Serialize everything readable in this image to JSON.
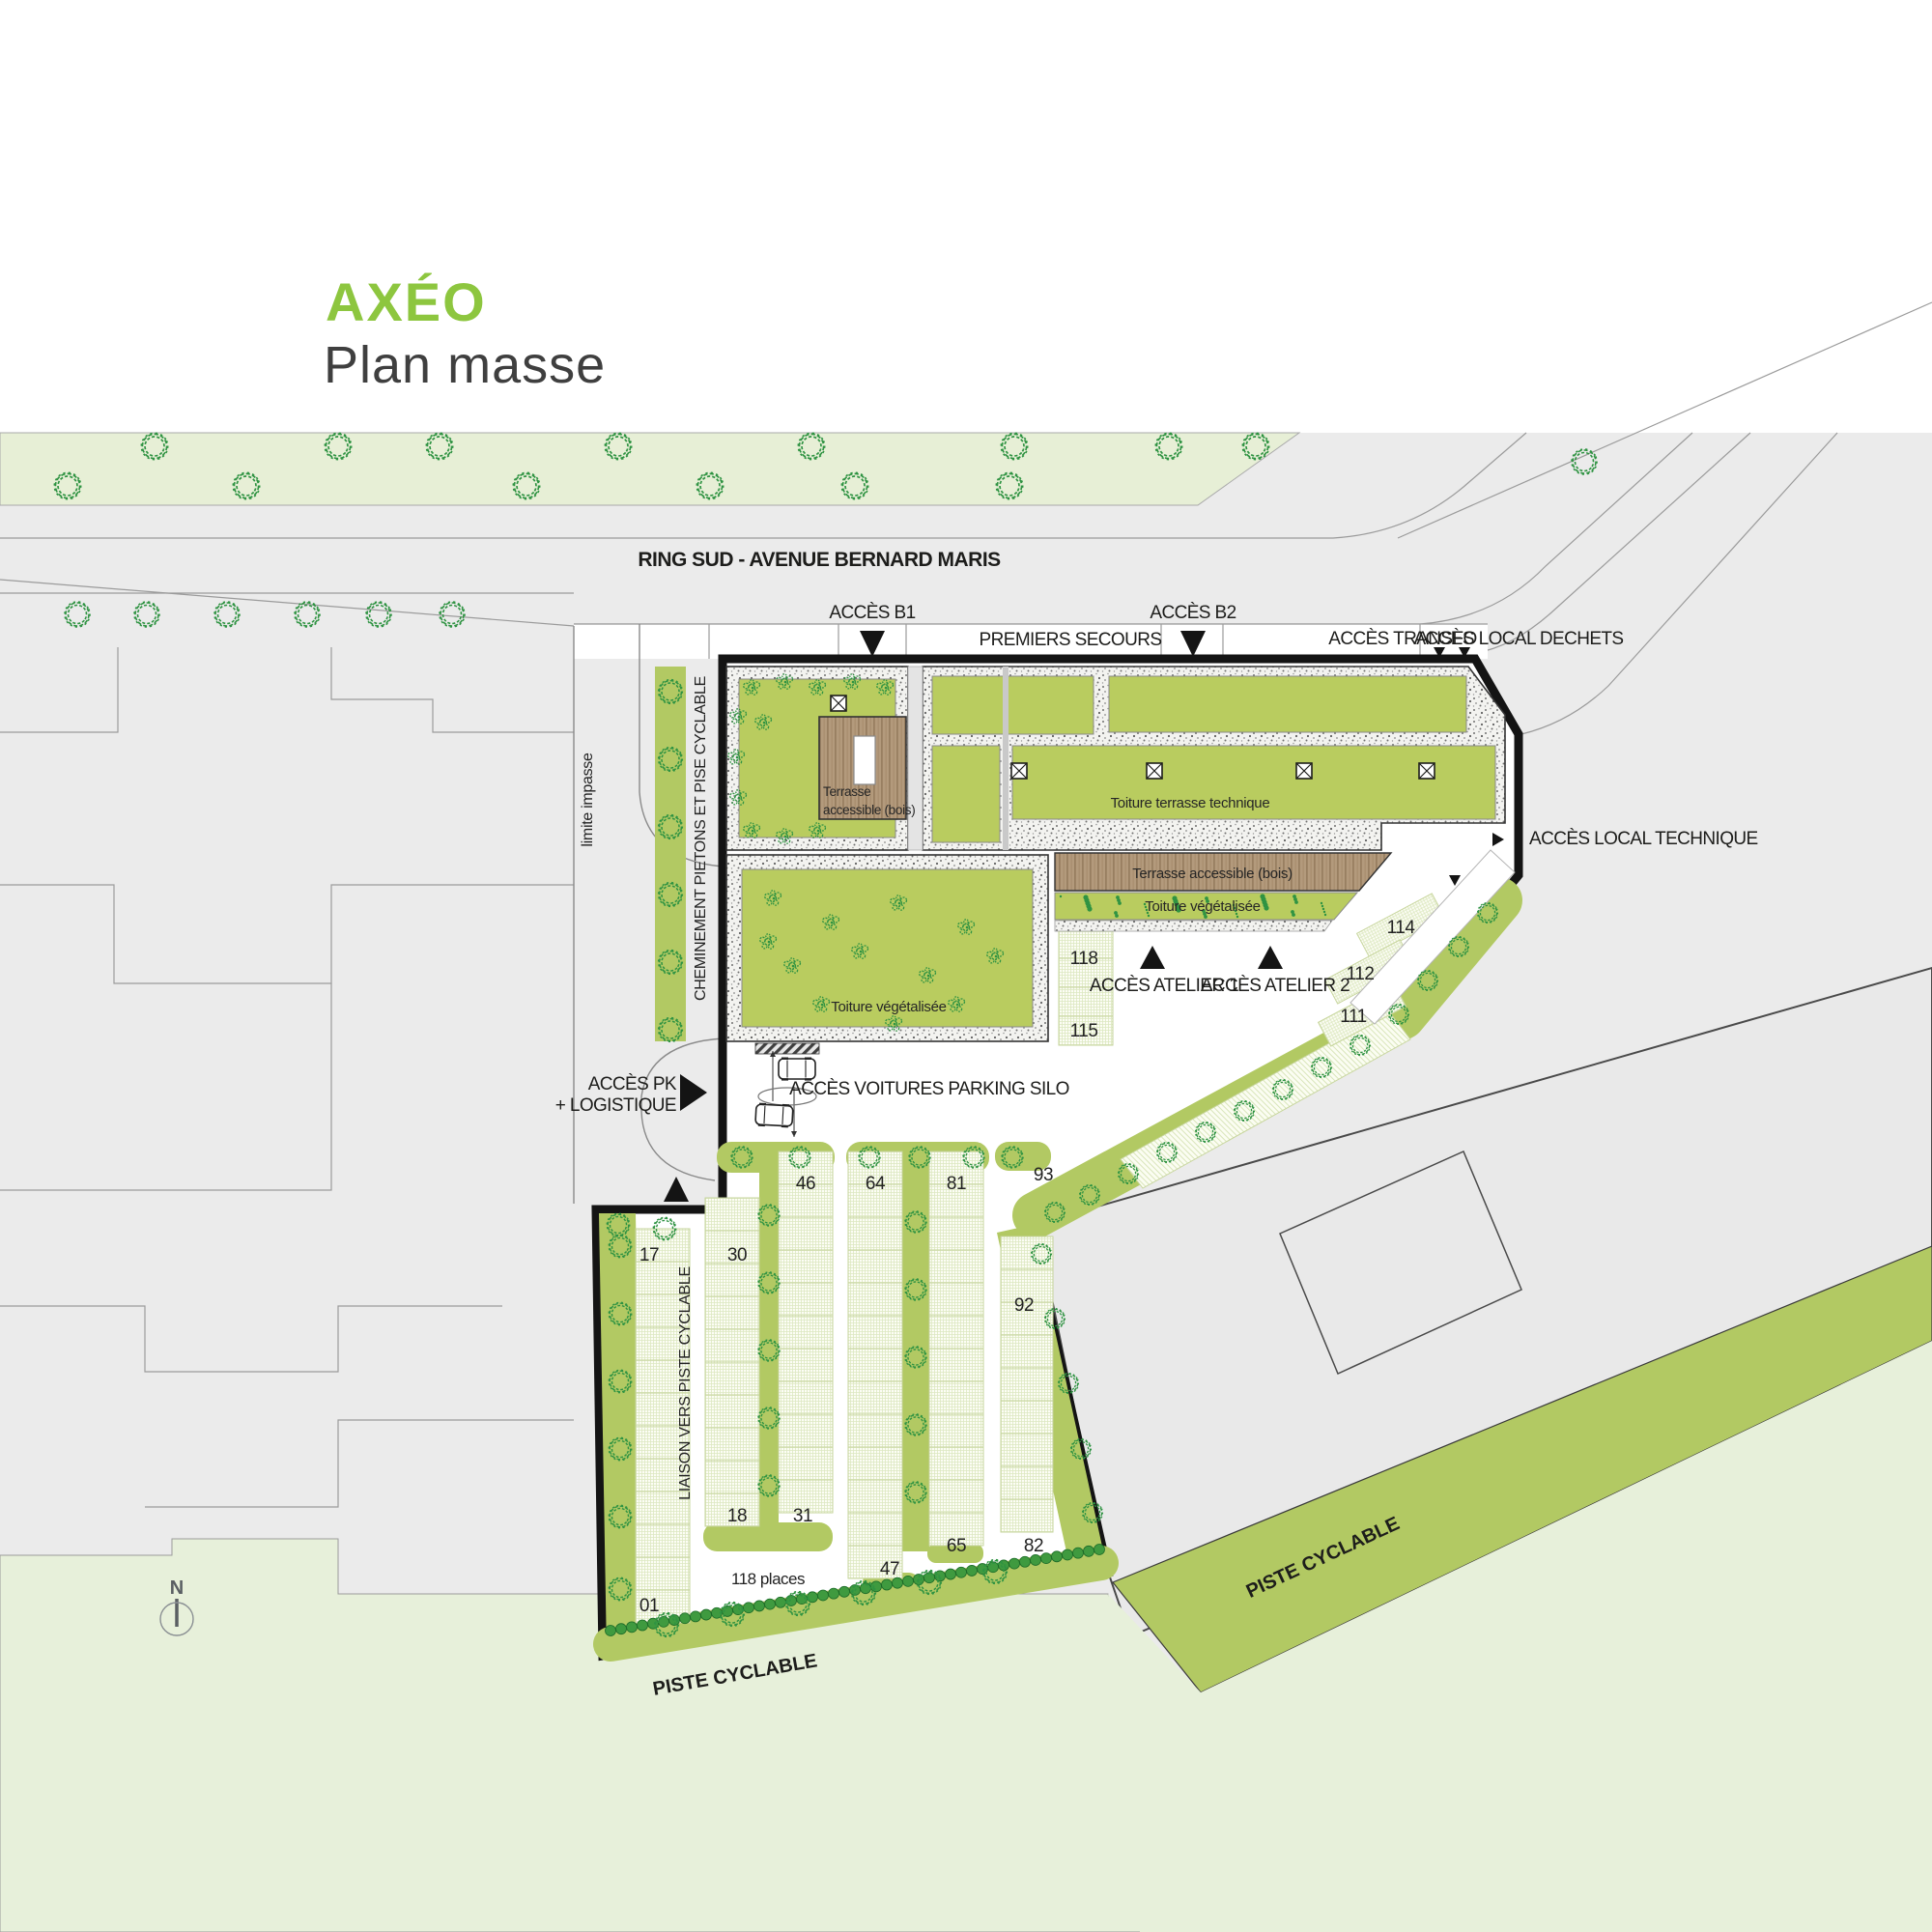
{
  "header": {
    "title": "AXÉO",
    "subtitle": "Plan masse"
  },
  "roads": {
    "main": "RING SUD - AVENUE BERNARD MARIS",
    "piste_left": "PISTE CYCLABLE",
    "piste_right": "PISTE CYCLABLE"
  },
  "access": {
    "b1": "ACCÈS B1",
    "b2": "ACCÈS B2",
    "premiers_secours": "PREMIERS SECOURS",
    "transfo": "ACCÈS TRANSFO",
    "local_dechets": "ACCÈS LOCAL DECHETS",
    "local_technique": "ACCÈS LOCAL TECHNIQUE",
    "atelier1": "ACCÈS ATELIER 1",
    "atelier2": "ACCÈS ATELIER 2",
    "pk_line1": "ACCÈS PK",
    "pk_line2": "+ LOGISTIQUE",
    "voitures_silo": "ACCÈS VOITURES PARKING SILO"
  },
  "roofs": {
    "terrasse_bois_line1": "Terrasse",
    "terrasse_bois_line2": "accessible (bois)",
    "terrasse_bois_2": "Terrasse accessible (bois)",
    "toiture_technique": "Toiture terrasse technique",
    "toiture_vegetalisee_1": "Toiture végétalisée",
    "toiture_vegetalisee_2": "Toiture végétalisée"
  },
  "paths": {
    "cheminement": "CHEMINEMENT PIETONS ET PISE CYCLABLE",
    "limite_impasse": "limite impasse",
    "liaison": "LIAISON VERS PISTE CYCLABLE"
  },
  "parking": {
    "total": "118 places",
    "bays": {
      "b118": "118",
      "b115": "115",
      "b114": "114",
      "b112": "112",
      "b111": "111",
      "b93": "93",
      "b92": "92",
      "b46": "46",
      "b64": "64",
      "b81": "81",
      "b17": "17",
      "b30": "30",
      "b18": "18",
      "b31": "31",
      "b47": "47",
      "b65": "65",
      "b82": "82",
      "b01": "01"
    }
  },
  "compass": {
    "north": "N"
  },
  "colors": {
    "accent_green": "#8dc63f",
    "roof_green": "#b9cc5f",
    "band_green": "#b2c963",
    "pale_green": "#e7efd6",
    "road_gray": "#ebebeb",
    "wood": "#b39a7c",
    "line_black": "#141414"
  }
}
